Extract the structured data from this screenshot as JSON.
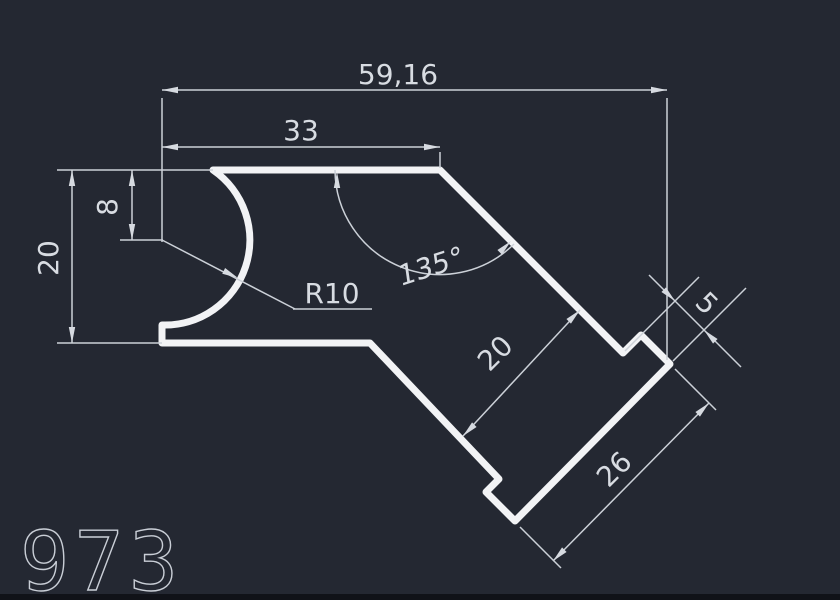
{
  "app": {
    "type": "cad-drawing-canvas",
    "background_color": "#242832",
    "outline_color": "#f2f3f5",
    "dimension_color": "#ccd1d8",
    "text_color": "#d8dce2"
  },
  "drawing": {
    "part_number": "973"
  },
  "dimensions": {
    "total_width": "59,16",
    "top_width": "33",
    "overall_height": "20",
    "arc_center_offset": "8",
    "corner_angle": "135°",
    "fillet_radius": "R10",
    "arm_width": "20",
    "step": "5",
    "end_cap_length": "26"
  }
}
